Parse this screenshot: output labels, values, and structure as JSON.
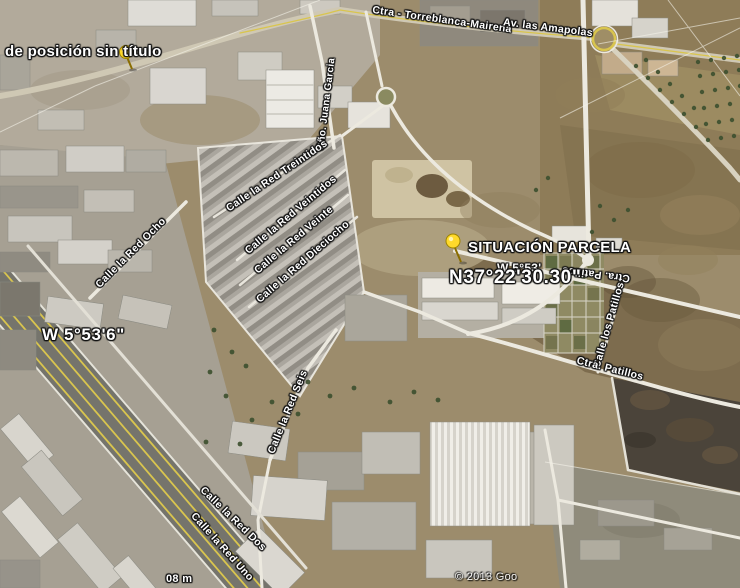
{
  "map_labels": {
    "placemark_untitled": "de posición sin título",
    "placemark_parcel": "SITUACIÓN PARCELA",
    "coordinate_north": "N37°22'30.30\"",
    "coordinate_west": "W 5°53'6\"",
    "coordinate_west_fragment": "W 5°53'",
    "scale_fragment": "08 m",
    "copyright": "© 2013 Goo"
  },
  "streets": [
    {
      "name": "Ctra - Torreblanca-Mairena",
      "x": 442,
      "y": 20,
      "rot": 8,
      "fs": 10.5
    },
    {
      "name": "Av. las Amapolas",
      "x": 548,
      "y": 28,
      "rot": 7,
      "fs": 10.5
    },
    {
      "name": "Cño. Juana Garcia",
      "x": 327,
      "y": 104,
      "rot": -83,
      "fs": 10
    },
    {
      "name": "Calle la Red Treintidos",
      "x": 277,
      "y": 176,
      "rot": -34,
      "fs": 10.5
    },
    {
      "name": "Calle la Red Veintidos",
      "x": 291,
      "y": 215,
      "rot": -40,
      "fs": 10.5
    },
    {
      "name": "Calle la Red Veinte",
      "x": 294,
      "y": 240,
      "rot": -40,
      "fs": 10.5
    },
    {
      "name": "Calle la Red Dieciocho",
      "x": 303,
      "y": 262,
      "rot": -41,
      "fs": 10.5
    },
    {
      "name": "Calle la Red Ocho",
      "x": 131,
      "y": 253,
      "rot": -45,
      "fs": 10.5
    },
    {
      "name": "Calle la Red Seis",
      "x": 288,
      "y": 412,
      "rot": -68,
      "fs": 10.5
    },
    {
      "name": "Calle la Red Dos",
      "x": 233,
      "y": 519,
      "rot": 44,
      "fs": 10.5
    },
    {
      "name": "Calle la Red Uno",
      "x": 222,
      "y": 547,
      "rot": 48,
      "fs": 10.5
    },
    {
      "name": "Calle los Patillos",
      "x": 609,
      "y": 325,
      "rot": -74,
      "fs": 10.5
    },
    {
      "name": "Ctra. Patillos",
      "x": 610,
      "y": 369,
      "rot": 14,
      "fs": 10.5
    },
    {
      "name": "Ctra. Patillos",
      "x": 596,
      "y": 274,
      "rot": 187,
      "fs": 10.5
    }
  ],
  "colors": {
    "pin_yellow": "#ffd92b",
    "highway_line_yellow": "#d9c54e",
    "label_white": "#ffffff",
    "terrain_tan": "#9c8c6c",
    "burnt_field": "#4b443a"
  }
}
